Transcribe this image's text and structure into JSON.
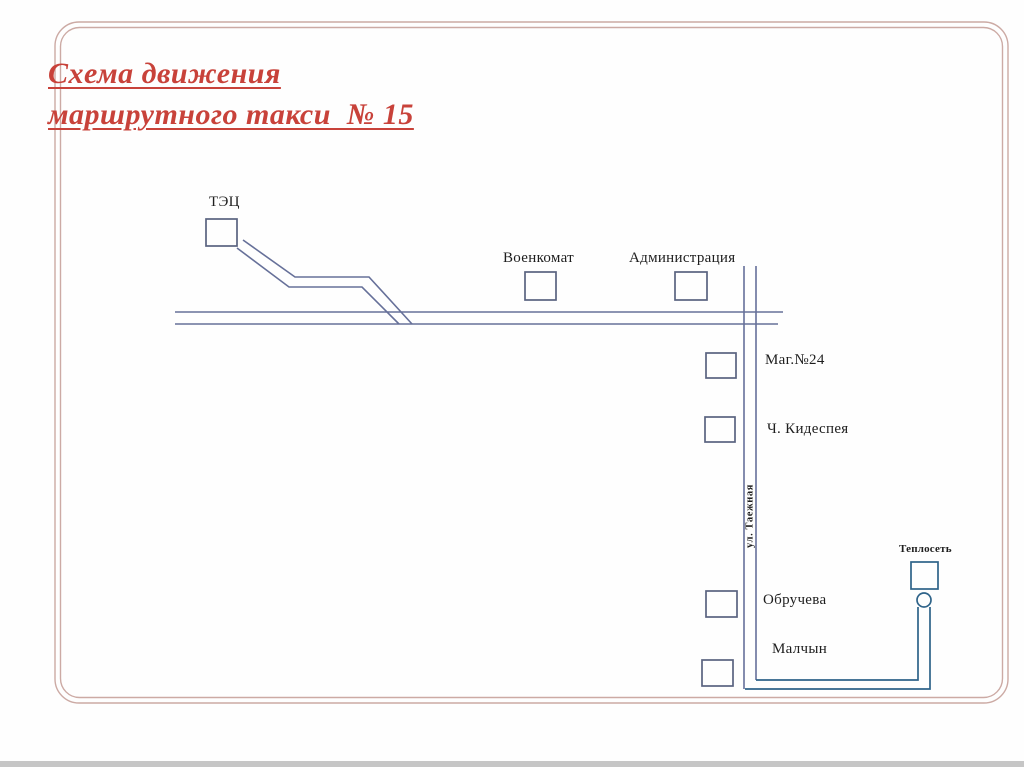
{
  "slide": {
    "title": {
      "line1": "Схема движения",
      "line2": "маршрутного такси  № 15"
    }
  },
  "labels": {
    "tec": "ТЭЦ",
    "voenkomat": "Военкомат",
    "administration": "Администрация",
    "shop24": "Маг.№24",
    "kidespeya": "Ч. Кидеспея",
    "street_tayozhnaya": "ул. Таежная",
    "teploset": "Теплосеть",
    "obrucheva": "Обручева",
    "malchyn": "Малчын"
  },
  "colors": {
    "title": "#c8423a",
    "road": "#667099",
    "box": "#5a6380",
    "loop": "#2e6389",
    "border": "#ccaaa4",
    "label": "#1e1e1e"
  }
}
